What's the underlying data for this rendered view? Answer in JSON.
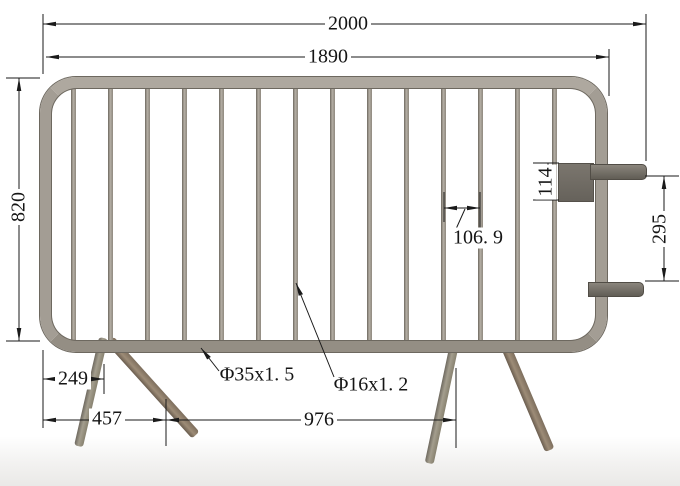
{
  "drawing": {
    "type": "technical-drawing",
    "subject": "crowd-control-barrier",
    "dims": {
      "overall_width": "2000",
      "frame_width": "1890",
      "height": "820",
      "hook_plate_height": "114",
      "hook_spacing": "295",
      "bar_spacing": "106. 9",
      "leg_inset": "249",
      "left_leg_span": "457",
      "leg_distance": "976"
    },
    "tube_labels": {
      "main_frame": "Φ35x1. 5",
      "infill_bars": "Φ16x1. 2"
    },
    "colors": {
      "background": "#ffffff",
      "dimension_lines": "#1a1a1a",
      "tube": "#a39d94",
      "tube_edge": "#6d685f",
      "tube_highlight": "#b3ada3",
      "hook_plate": "#6f6b64",
      "front_leg": "#8d7c6c",
      "back_leg": "#95907f"
    }
  }
}
